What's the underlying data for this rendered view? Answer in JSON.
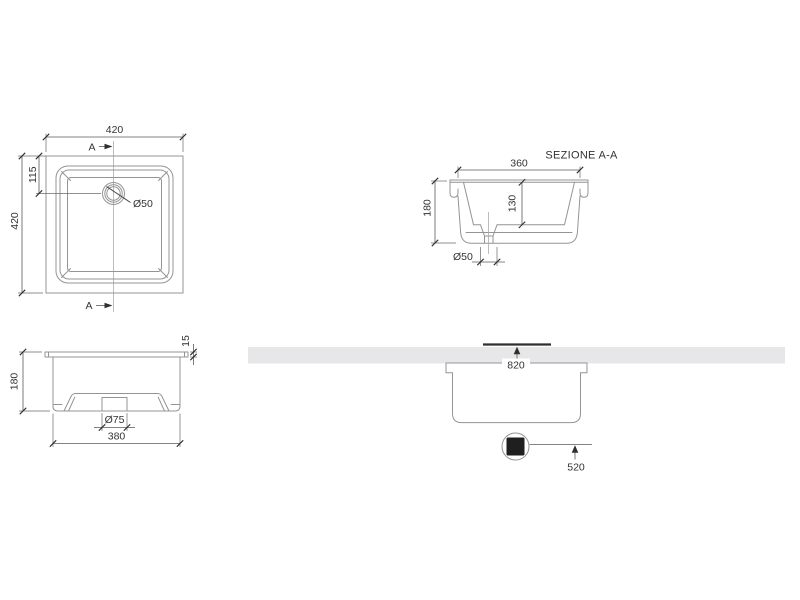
{
  "drawing": {
    "plan_view": {
      "width_label": "420",
      "height_label": "420",
      "drain_offset_label": "115",
      "drain_diameter_label": "Ø50",
      "section_marker_top": "A",
      "section_marker_bottom": "A"
    },
    "section_view": {
      "title": "SEZIONE A-A",
      "width_label": "360",
      "height_label": "180",
      "inner_depth_label": "130",
      "drain_diameter_label": "Ø50"
    },
    "front_view": {
      "width_label": "380",
      "height_label": "180",
      "rim_thickness_label": "15",
      "drain_boss_diameter_label": "Ø75"
    },
    "installation_view": {
      "cutout_width_label": "820",
      "drain_distance_label": "520"
    },
    "colors": {
      "outline": "#949494",
      "dimension": "#5a5a5a",
      "text": "#333333",
      "countertop_fill": "#e7e7e9",
      "drain_square_fill": "#1f1f1f"
    }
  }
}
